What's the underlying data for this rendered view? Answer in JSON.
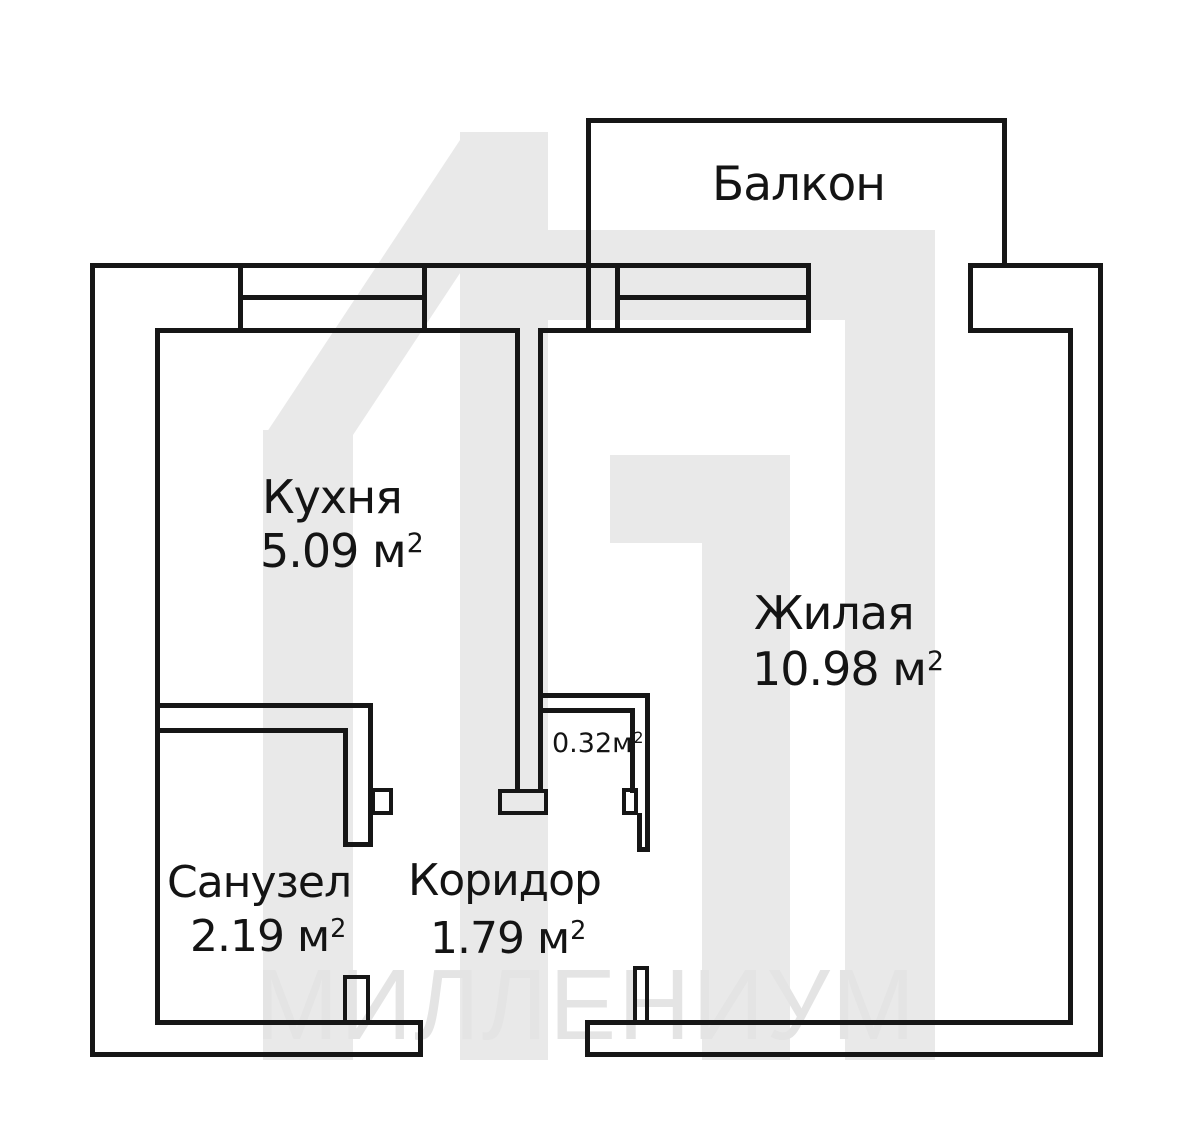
{
  "plan": {
    "watermark": {
      "text": "МИЛЛЕНИУМ",
      "color": "#e9e9e9"
    },
    "colors": {
      "line": "#161616",
      "label": "#141414"
    },
    "rooms": [
      {
        "id": "balcony",
        "name": "Балкон",
        "area": "",
        "area_sup": ""
      },
      {
        "id": "kitchen",
        "name": "Кухня",
        "area": "5.09 м",
        "area_sup": "2"
      },
      {
        "id": "living",
        "name": "Жилая",
        "area": "10.98 м",
        "area_sup": "2"
      },
      {
        "id": "bathroom",
        "name": "Санузел",
        "area": "2.19 м",
        "area_sup": "2"
      },
      {
        "id": "corridor",
        "name": "Коридор",
        "area": "1.79 м",
        "area_sup": "2"
      },
      {
        "id": "closet",
        "name": "",
        "area": "0.32м",
        "area_sup": "2"
      }
    ]
  }
}
